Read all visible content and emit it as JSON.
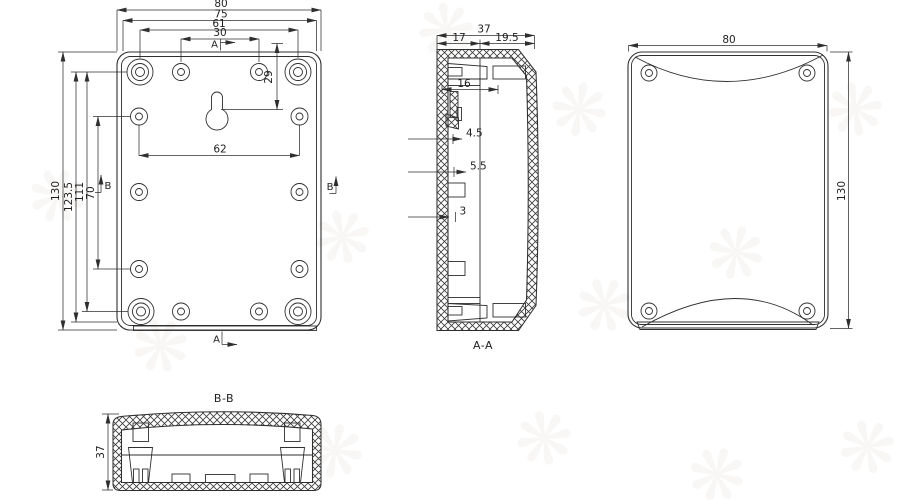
{
  "views": {
    "front": {
      "marker_a_top": "A",
      "marker_a_bottom": "A",
      "marker_b_left": "B",
      "marker_b_right": "B",
      "dim_width_outer": "80",
      "dim_width_inner": "75",
      "dim_boss_span": "61",
      "dim_hole_span_top": "30",
      "dim_height_outer": "130",
      "dim_height_1": "123.5",
      "dim_height_2": "111",
      "dim_hole_span_left": "70",
      "dim_keyhole_offset": "29",
      "dim_hole_span_bottom": "62"
    },
    "section_aa": {
      "label": "A-A",
      "dim_depth": "37",
      "dim_depth_left": "17",
      "dim_depth_right": "19.5",
      "dim_boss_width": "16",
      "dim_rib_1": "4.5",
      "dim_rib_2": "5.5",
      "dim_wall": "3"
    },
    "back": {
      "dim_width": "80",
      "dim_height": "130"
    },
    "section_bb": {
      "label": "B-B",
      "dim_depth": "37"
    }
  },
  "colors": {
    "line": "#2f2f2f",
    "background": "#ffffff",
    "watermark": "#8a7a5f"
  },
  "watermark_glyph": "❋"
}
